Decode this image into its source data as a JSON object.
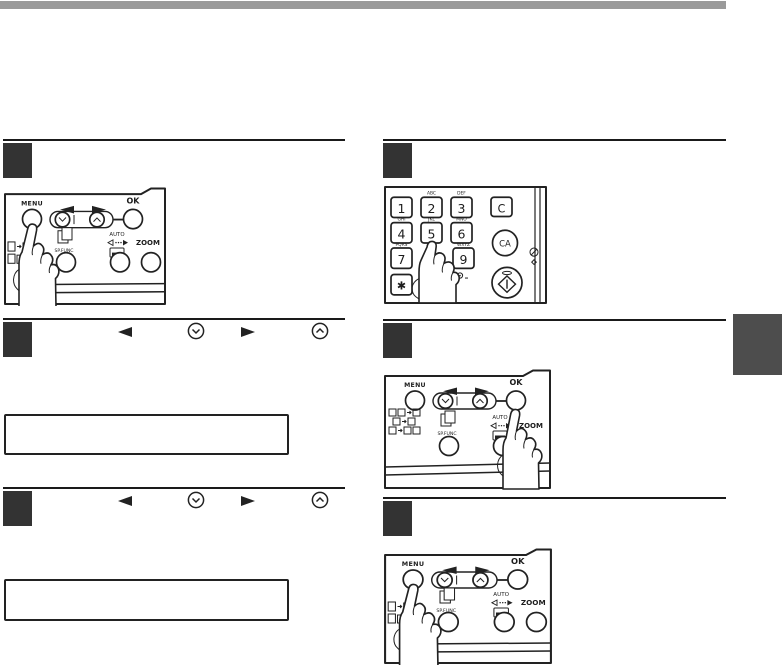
{
  "page": {
    "background": "#ffffff",
    "top_bar_color": "#9a9a9a",
    "rule_color": "#1a1a1a",
    "step_marker_color": "#333333",
    "side_tab_color": "#4d4d4d",
    "line_art_color": "#222222"
  },
  "panel_labels": {
    "menu": "MENU",
    "ok": "OK",
    "zoom": "ZOOM",
    "sp_func": "SP.FUNC",
    "auto": "AUTO"
  },
  "keypad": {
    "clear_key": "C",
    "clear_all_key": "CA",
    "star_key": "✱",
    "keys": [
      {
        "digit": "1",
        "letters": ""
      },
      {
        "digit": "2",
        "letters": "ABC"
      },
      {
        "digit": "3",
        "letters": "DEF"
      },
      {
        "digit": "4",
        "letters": "GHI"
      },
      {
        "digit": "5",
        "letters": "JKL"
      },
      {
        "digit": "6",
        "letters": "MNO"
      },
      {
        "digit": "7",
        "letters": "PQRS"
      },
      {
        "digit": "9",
        "letters": "WXYZ"
      }
    ]
  },
  "icons": {
    "header_keys": [
      "left-arrow-key-icon",
      "down-arrow-key-icon",
      "right-arrow-key-icon",
      "up-arrow-key-icon"
    ],
    "panel_icons": [
      "copy-function-icons",
      "sort-copy-icon",
      "auto-ratio-icon",
      "paper-icon",
      "hand-pointer"
    ],
    "keypad_icons": [
      "interrupt-indicator-icon",
      "readend-symbol-icon",
      "start-key-icon"
    ]
  }
}
